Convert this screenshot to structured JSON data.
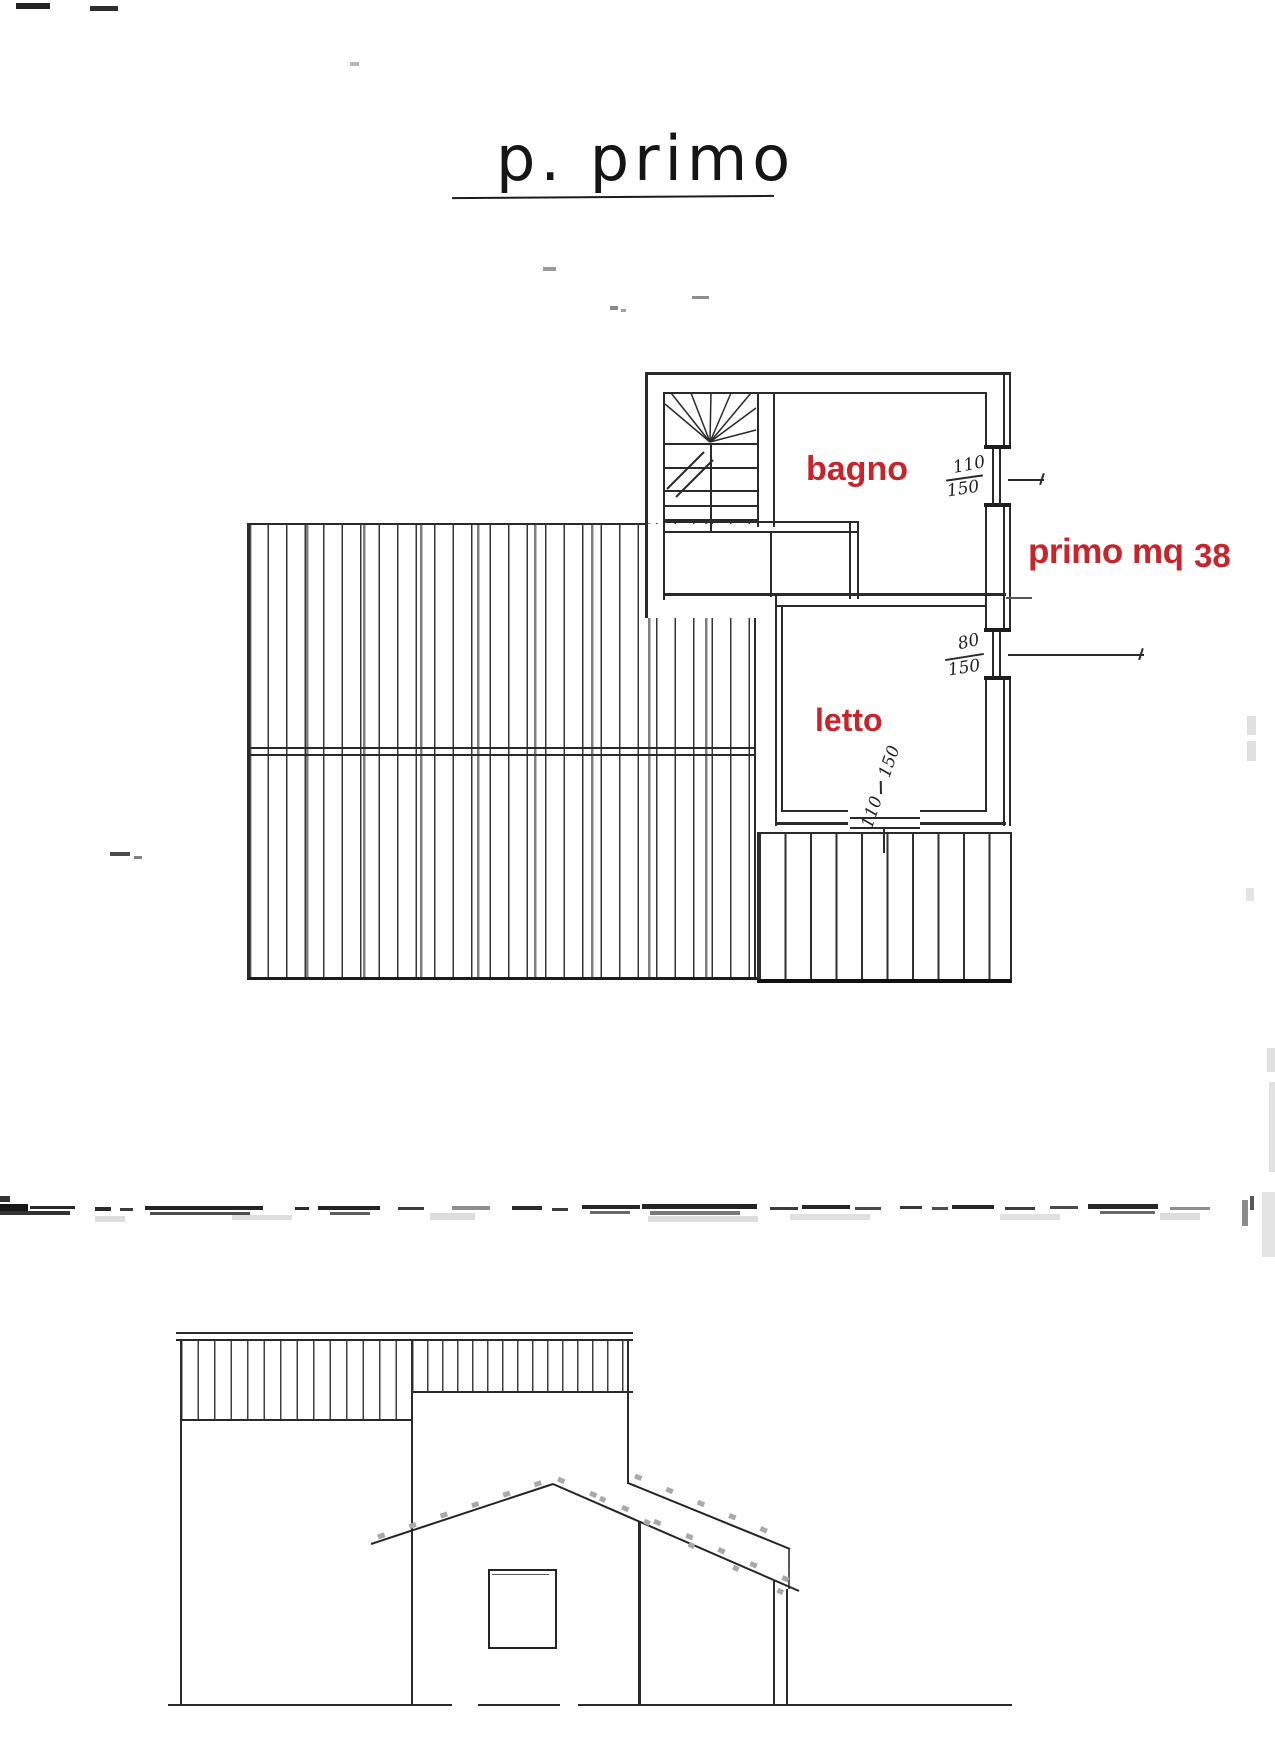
{
  "title": {
    "text": "p. primo"
  },
  "floor_plan": {
    "room_labels": [
      {
        "id": "bagno",
        "text": "bagno"
      },
      {
        "id": "letto",
        "text": "letto"
      }
    ],
    "area_note": {
      "label": "primo mq",
      "value": "38"
    },
    "window_dimensions": {
      "bagno_window": {
        "width": "110",
        "height": "150"
      },
      "letto_window": {
        "width": "80",
        "height": "150"
      },
      "terrace_door": {
        "width": "110",
        "height": "150"
      }
    }
  },
  "colors": {
    "label_red": "#c8242b",
    "line": "#2a2a2a"
  }
}
